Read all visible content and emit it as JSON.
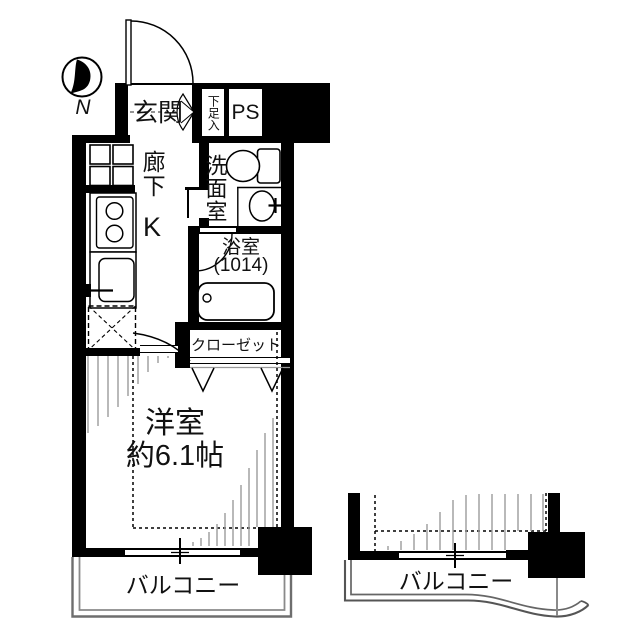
{
  "compass": {
    "north_label": "N"
  },
  "labels": {
    "entrance": "玄関",
    "shoe_storage": "下足入",
    "pipe_space": "PS",
    "corridor": "廊下",
    "kitchen": "K",
    "washroom": "洗面室",
    "bathroom": "浴室",
    "bathroom_size": "(1014)",
    "closet": "クローゼット",
    "western_room": "洋室",
    "western_room_size": "約6.1帖",
    "balcony_main": "バルコニー",
    "balcony_neighbor": "バルコニー"
  },
  "colors": {
    "wall": "#000000",
    "hatch": "#9b9b9b",
    "balcony_outline": "#6e6e6e"
  }
}
